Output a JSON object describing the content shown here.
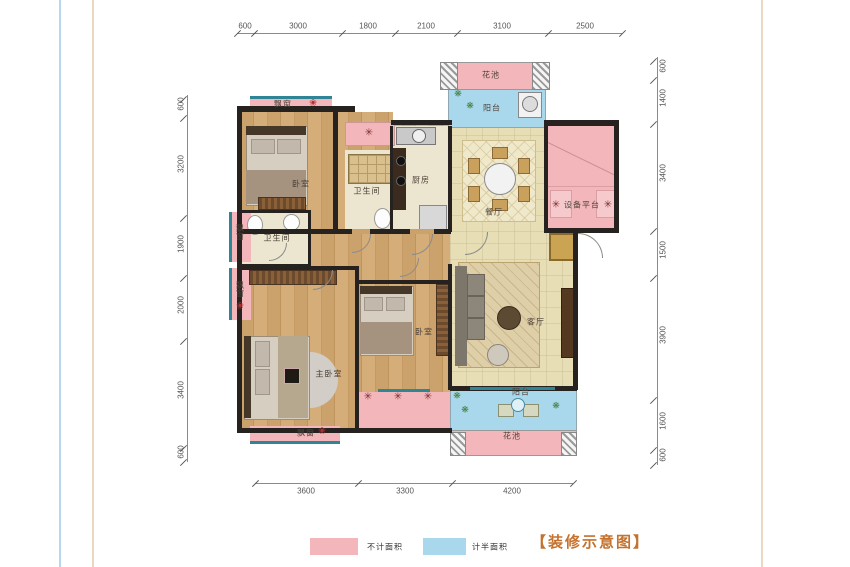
{
  "title": {
    "text": "【装修示意图】",
    "color": "#c4722e"
  },
  "legend": [
    {
      "label": "不计面积",
      "color": "#f2b6bb"
    },
    {
      "label": "计半面积",
      "color": "#a9d8ec"
    }
  ],
  "rooms": {
    "bedroom_top": "卧室",
    "bath_top": "卫生间",
    "kitchen": "厨房",
    "dining": "餐厅",
    "balcony_top": "阳台",
    "flower_top": "花池",
    "equipment": "设备平台",
    "bath_mid": "卫生间",
    "master": "主卧室",
    "bedroom_mid": "卧室",
    "living": "客厅",
    "balcony_bottom": "阳台",
    "flower_bottom": "花池",
    "bay_top": "飘窗",
    "bay_left1": "飘窗",
    "bay_left2": "飘窗",
    "bay_bottom": "飘窗"
  },
  "dims": {
    "top": [
      "600",
      "3000",
      "1800",
      "2100",
      "3100",
      "2500"
    ],
    "left": [
      "600",
      "3200",
      "1900",
      "2000",
      "3400",
      "600"
    ],
    "right": [
      "600",
      "1400",
      "3400",
      "1500",
      "3900",
      "1600",
      "600"
    ],
    "bottom": [
      "3600",
      "3300",
      "4200"
    ]
  },
  "icons": {
    "ac_fan": "✳",
    "flower": "❀",
    "plant": "❋"
  },
  "colors": {
    "no_area_pink": "#f2b6bb",
    "half_area_blue": "#a9d8ec",
    "window_teal": "#2f8496",
    "wall": "#262220"
  }
}
